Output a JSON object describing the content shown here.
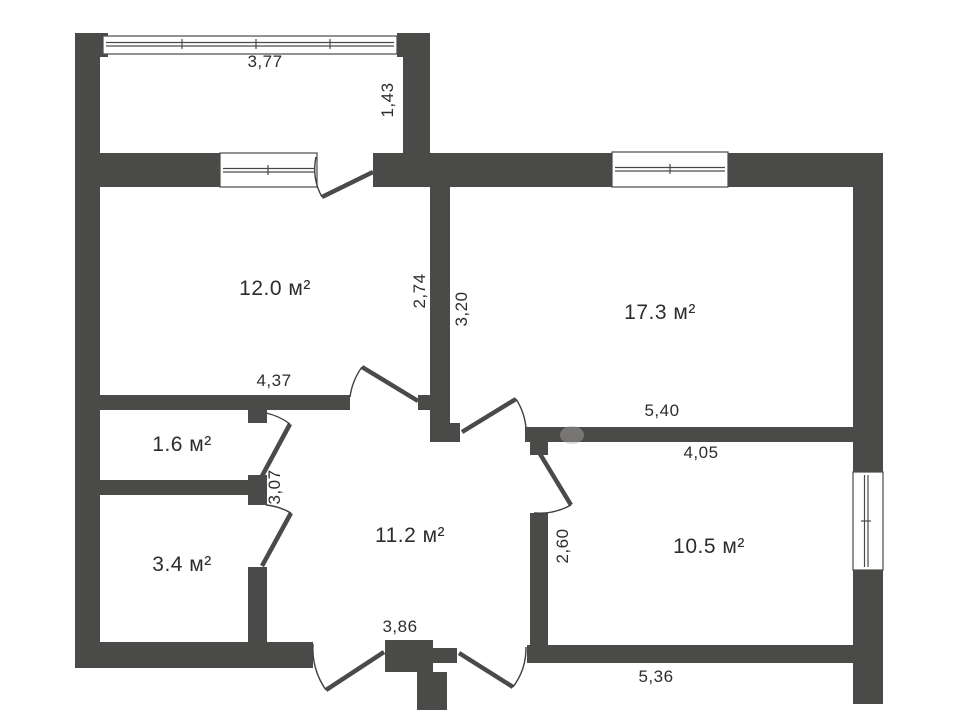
{
  "rooms": {
    "room12": "12.0 м²",
    "room17": "17.3 м²",
    "room16": "1.6 м²",
    "room34": "3.4 м²",
    "room112": "11.2 м²",
    "room105": "10.5 м²"
  },
  "dims": {
    "balcony_width": "3,77",
    "balcony_depth": "1,43",
    "room12_width": "4,37",
    "room12_depth": "2,74",
    "room17_depth": "3,20",
    "room17_width": "5,40",
    "room105_width": "4,05",
    "room105_depth": "2,60",
    "hall_depth": "3,07",
    "hall_width": "3,86",
    "bottom_width": "5,36"
  },
  "colors": {
    "wall": "#4a4a48",
    "line": "#3f3f3d",
    "text": "#2d2d2b"
  }
}
